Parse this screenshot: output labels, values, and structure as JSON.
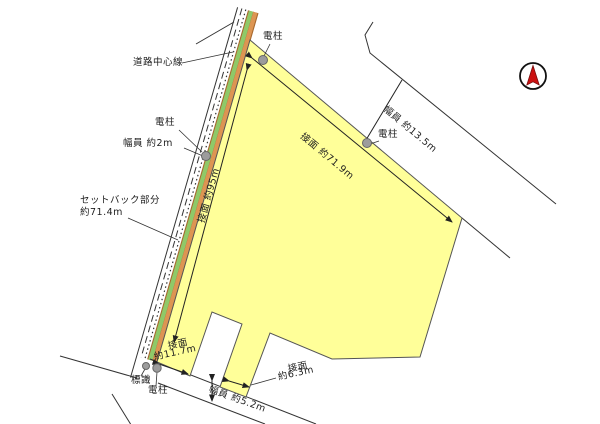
{
  "diagram": {
    "type": "land-plot-survey-map",
    "labels": {
      "road_centerline": "道路中心線",
      "pole_top": "電柱",
      "pole_mid": "電柱",
      "pole_right": "電柱",
      "pole_bottom": "電柱",
      "sign": "標識",
      "width_left": "幅員 約2m",
      "setback_line1": "セットバック部分",
      "setback_line2": "約71.4m",
      "frontage_left": "接面 約95m",
      "frontage_top": "接面 約71.9m",
      "width_top_right": "幅員 約13.5m",
      "frontage_bottom_left_line1": "接面",
      "frontage_bottom_left_line2": "約11.7m",
      "frontage_bottom_mid_line1": "接面",
      "frontage_bottom_mid_line2": "約6.3m",
      "width_bottom": "幅員 約5.2m"
    },
    "colors": {
      "parcel_fill": "#FFFF99",
      "setback_strip_green": "#8FC968",
      "road_strip_orange": "#DD9552",
      "strip_border_brown": "#A8692E",
      "compass_red": "#CC1111",
      "line": "#333333",
      "pole_gray": "#9C9C9C"
    }
  }
}
